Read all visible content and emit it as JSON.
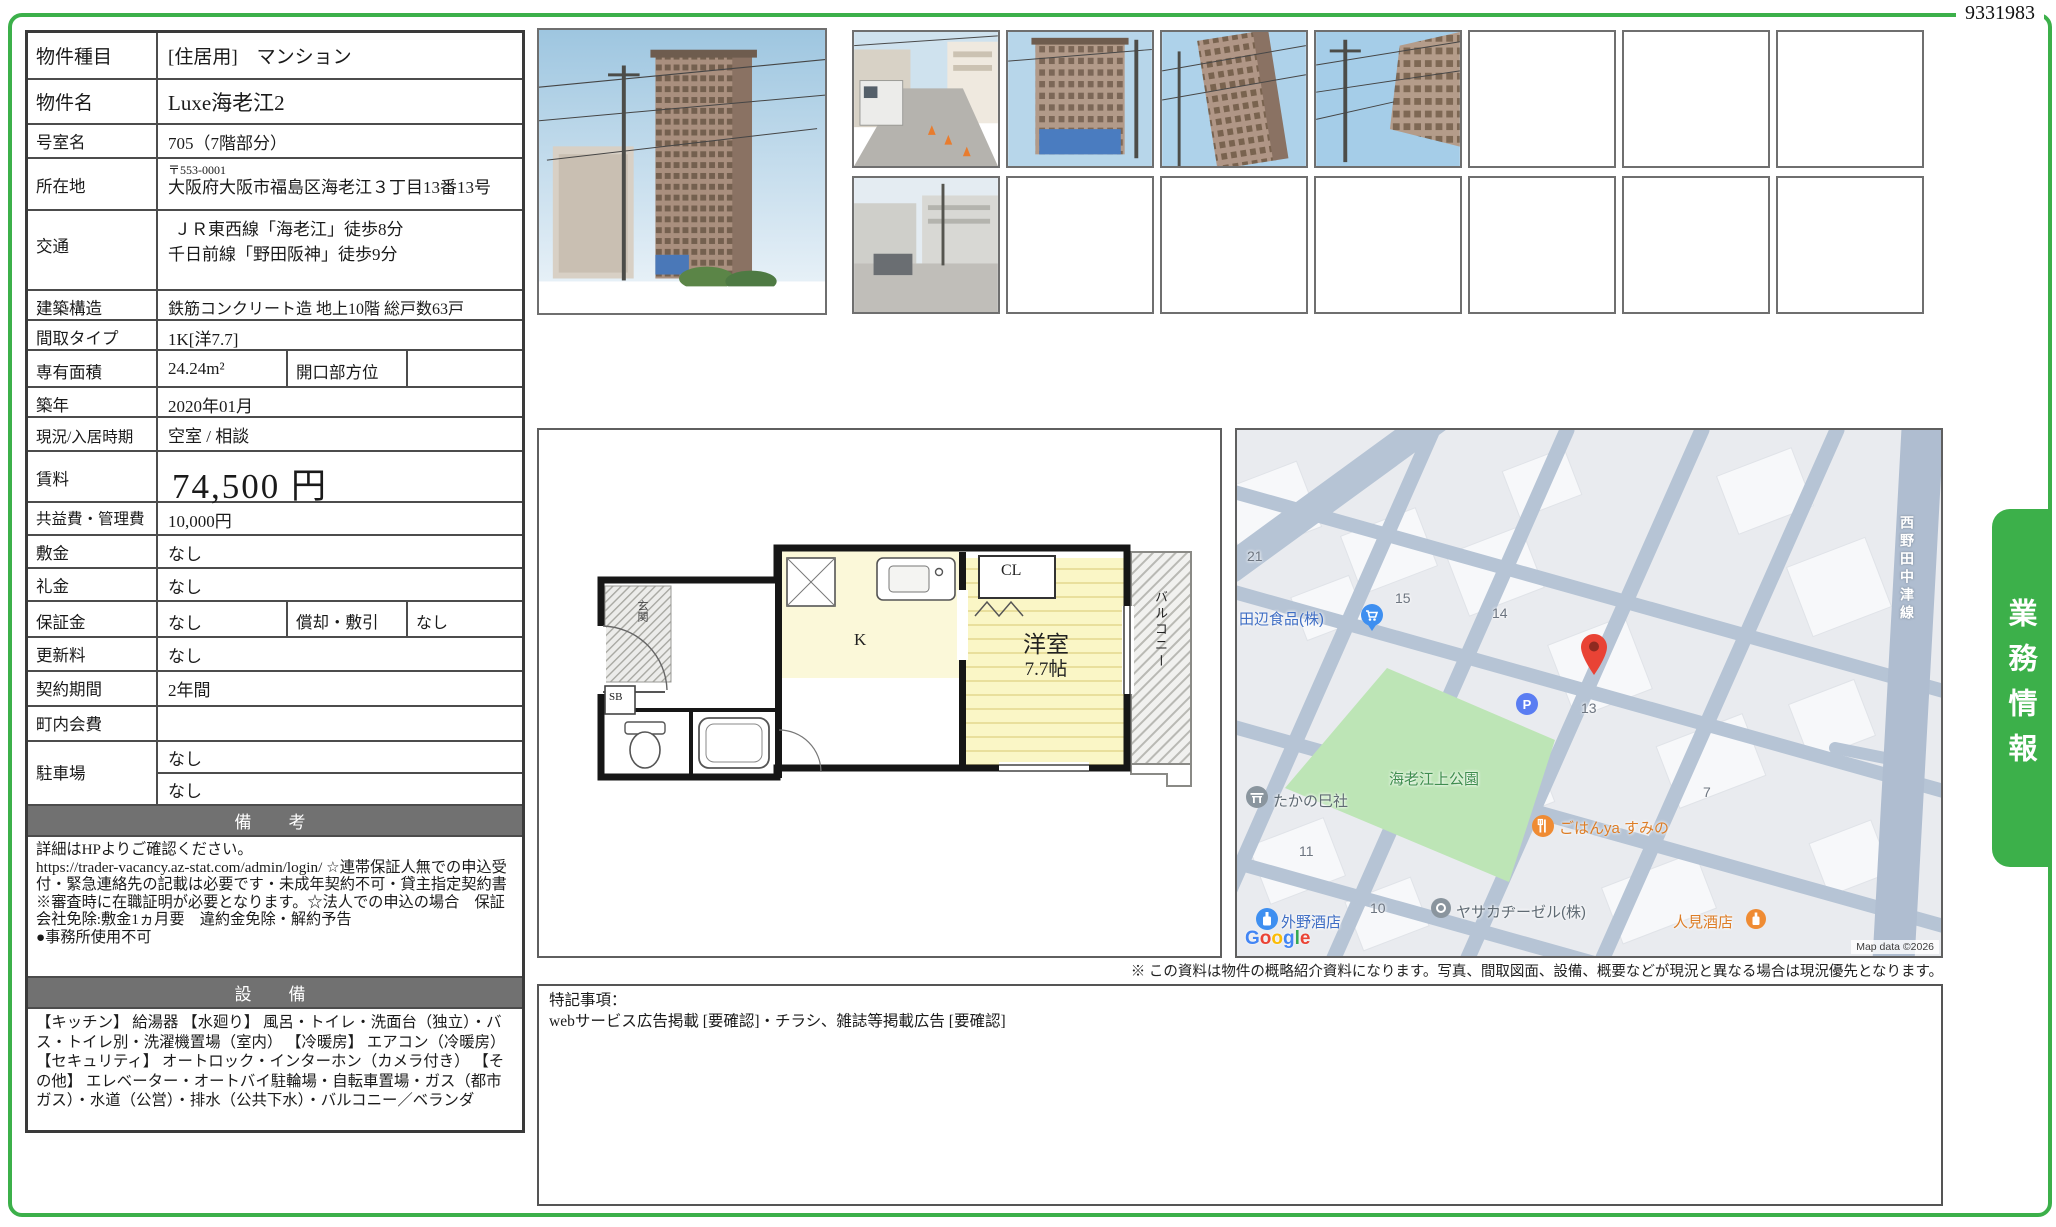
{
  "doc_id": "9331983",
  "side_tab": "業務情報",
  "colors": {
    "accent_green": "#3cb04a",
    "header_gray": "#717171",
    "marker_red": "#ea4335"
  },
  "table": {
    "property_type": {
      "label": "物件種目",
      "value": "[住居用]　マンション"
    },
    "property_name": {
      "label": "物件名",
      "value": "Luxe海老江2"
    },
    "room_no": {
      "label": "号室名",
      "value": "705（7階部分）"
    },
    "address": {
      "label": "所在地",
      "postal": "〒553-0001",
      "value": "大阪府大阪市福島区海老江３丁目13番13号"
    },
    "transport": {
      "label": "交通",
      "line1": "ＪＲ東西線「海老江」徒歩8分",
      "line2": "千日前線「野田阪神」徒歩9分"
    },
    "structure": {
      "label": "建築構造",
      "value": "鉄筋コンクリート造 地上10階 総戸数63戸"
    },
    "layout": {
      "label": "間取タイプ",
      "value": "1K[洋7.7]"
    },
    "area": {
      "label": "専有面積",
      "value": "24.24m²",
      "sub_label": "開口部方位",
      "sub_value": ""
    },
    "built": {
      "label": "築年",
      "value": "2020年01月"
    },
    "status": {
      "label": "現況/入居時期",
      "value": "空室 /  相談"
    },
    "rent": {
      "label": "賃料",
      "value": "74,500 円"
    },
    "fees": {
      "label": "共益費・管理費",
      "value": "10,000円"
    },
    "deposit": {
      "label": "敷金",
      "value": "なし"
    },
    "key_money": {
      "label": "礼金",
      "value": "なし"
    },
    "guarantee": {
      "label": "保証金",
      "value": "なし",
      "sub_label": "償却・敷引",
      "sub_value": "なし"
    },
    "renewal": {
      "label": "更新料",
      "value": "なし"
    },
    "term": {
      "label": "契約期間",
      "value": "2年間"
    },
    "town_fee": {
      "label": "町内会費",
      "value": ""
    },
    "parking": {
      "label": "駐車場",
      "value1": "なし",
      "value2": "なし"
    }
  },
  "remarks": {
    "header": "備　考",
    "text": "詳細はHPよりご確認ください。\nhttps://trader-vacancy.az-stat.com/admin/login/ ☆連帯保証人無での申込受付・緊急連絡先の記載は必要です・未成年契約不可・貸主指定契約書※審査時に在職証明が必要となります。☆法人での申込の場合　保証会社免除:敷金1ヵ月要　違約金免除・解約予告\n●事務所使用不可"
  },
  "equipment": {
    "header": "設　備",
    "text": "【キッチン】 給湯器 【水廻り】 風呂・トイレ・洗面台（独立）・バス・トイレ別・洗濯機置場（室内） 【冷暖房】 エアコン（冷暖房） 【セキュリティ】 オートロック・インターホン（カメラ付き） 【その他】 エレベーター・オートバイ駐輪場・自転車置場・ガス（都市ガス）・水道（公営）・排水（公共下水）・バルコニー／ベランダ"
  },
  "floorplan": {
    "room": "洋室",
    "size": "7.7帖",
    "kitchen": "K",
    "closet": "CL",
    "balcony": "バルコニー",
    "entrance": "玄関",
    "sb": "SB"
  },
  "map": {
    "numbers": {
      "n21": "21",
      "n15": "15",
      "n14": "14",
      "n13": "13",
      "n11": "11",
      "n10": "10",
      "n7": "7"
    },
    "pois": {
      "tanabe": "田辺食品(株)",
      "park": "海老江上公園",
      "takano": "たかの巳社",
      "gohan": "ごはんya すみの",
      "yasaka": "ヤサカヂーゼル(株)",
      "tonoya": "外野酒店",
      "hitomi": "人見酒店"
    },
    "road_label": "西野田中津線",
    "google_logo": {
      "letters": [
        "G",
        "o",
        "o",
        "g",
        "l",
        "e"
      ]
    },
    "attribution": "Map data ©2026"
  },
  "disclaimer": "※ この資料は物件の概略紹介資料になります。写真、間取図面、設備、概要などが現況と異なる場合は現況優先となります。",
  "notes": {
    "title": "特記事項：",
    "text": "webサービス広告掲載 [要確認]・チラシ、雑誌等掲載広告 [要確認]"
  }
}
